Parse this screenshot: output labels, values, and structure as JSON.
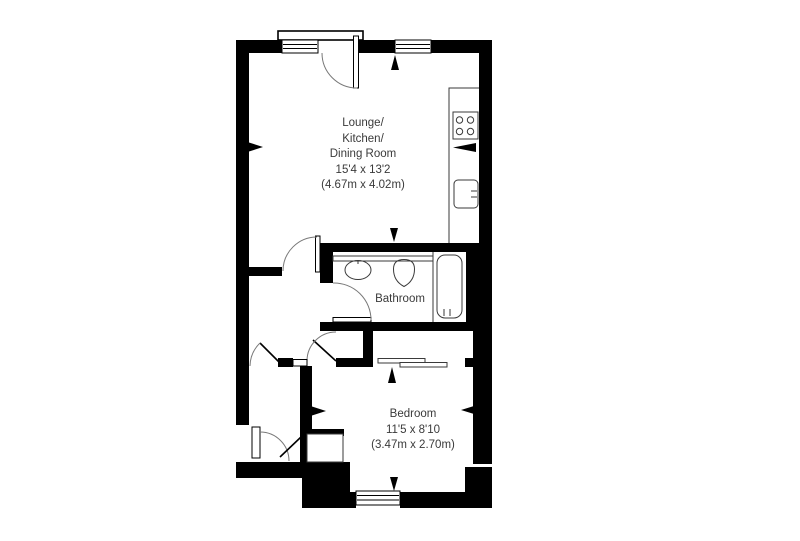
{
  "plan": {
    "title": "Flat floor plan",
    "rooms": {
      "lounge": {
        "name_lines": [
          "Lounge/",
          "Kitchen/",
          "Dining Room"
        ],
        "size_imperial": "15'4 x 13'2",
        "size_metric": "(4.67m x 4.02m)"
      },
      "bathroom": {
        "name": "Bathroom"
      },
      "bedroom": {
        "name": "Bedroom",
        "size_imperial": "11'5 x 8'10",
        "size_metric": "(3.47m x 2.70m)"
      }
    },
    "fixtures": [
      "hob",
      "kitchen-counter",
      "kitchen-sink",
      "wash-basin",
      "toilet",
      "bathtub",
      "wardrobe-sliding-doors",
      "hall-cupboard",
      "windows",
      "door-swings",
      "measurement-markers"
    ],
    "colors": {
      "walls": "#000000",
      "fixture_lines": "#3a3a3a",
      "door_arcs": "#787878",
      "text": "#3a3a3a",
      "background": "#ffffff"
    }
  }
}
